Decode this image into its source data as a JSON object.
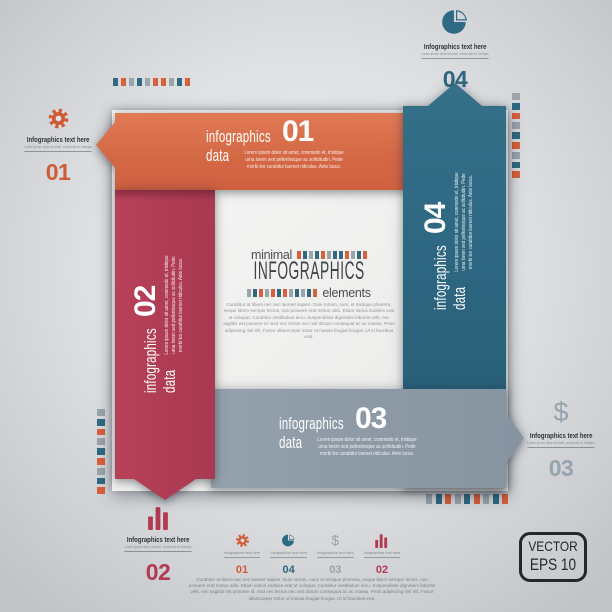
{
  "palette": {
    "orange": "#d2643f",
    "red": "#b23d54",
    "blue": "#2e6781",
    "gray_ribbon": "#8e9ba6",
    "badge_dark": "#24282d",
    "sheet": "#f2f2f1"
  },
  "strip_palette": {
    "t": "#2f6a82",
    "o": "#d9603c",
    "g": "#9aa5ac"
  },
  "strips": {
    "top": [
      "t",
      "o",
      "g",
      "t",
      "g",
      "o",
      "o",
      "g",
      "t",
      "o"
    ],
    "right": [
      "g",
      "t",
      "o",
      "g",
      "t",
      "o",
      "g",
      "t",
      "o"
    ],
    "left": [
      "g",
      "t",
      "o",
      "g",
      "t",
      "o",
      "g",
      "t",
      "o"
    ],
    "bottom": [
      "g",
      "t",
      "o",
      "g",
      "t",
      "o",
      "g",
      "t",
      "o"
    ],
    "center_top": [
      "o",
      "t",
      "g",
      "t",
      "o",
      "g",
      "t",
      "t",
      "o",
      "g",
      "t",
      "o"
    ],
    "center_bottom": [
      "g",
      "t",
      "o",
      "g",
      "o",
      "t",
      "o",
      "g",
      "t",
      "g",
      "t",
      "o"
    ]
  },
  "ribbons": {
    "orange": {
      "label": "infographics\ndata",
      "number": "01",
      "lorem": "Lorem ipsum dolor sit amet, commodo et, tristique\nurna lorem sed pellentesque ac sollicitudin. Pede\nmorbi leo curabitur laoreet ridiculus. Ante lacus."
    },
    "red": {
      "label": "infographics\ndata",
      "number": "02",
      "lorem": "Lorem ipsum dolor sit amet, commodo et, tristique\nurna lorem sed pellentesque ac sollicitudin. Pede\nmorbi leo curabitur laoreet ridiculus. Ante lacus."
    },
    "gray": {
      "label": "infographics\ndata",
      "number": "03",
      "lorem": "Lorem ipsum dolor sit amet, commodo et, tristique\nurna lorem sed pellentesque ac sollicitudin. Pede\nmorbi leo curabitur laoreet ridiculus. Ante lacus."
    },
    "blue": {
      "label": "infographics\ndata",
      "number": "04",
      "lorem": "Lorem ipsum dolor sit amet, commodo et, tristique\nurna lorem sed pellentesque ac sollicitudin. Pede\nmorbi leo curabitur laoreet ridiculus. Ante lacus."
    }
  },
  "center": {
    "kicker": "minimal",
    "title": "INFOGRAPHICS",
    "tail": "elements",
    "paragraph": "Curabitur at libero nec nec laoreet sapien. Duis rutrum, nunc et tristique pharetra, neque libero semper lectus, non posuere erat metus odio. Etiam varius sodales erat ut volutpat. Curabitur vestibulum arcu. Suspendisse dignissim lobortis velit, nec sagittis est posuere id. Sed nec lectus nec nisl dictum consequat ac ac massa. Proin adipiscing nisl elit. Fusce ullamcorper tortor ut massa feugiat feugiat. Ut id faucibus erat."
  },
  "callouts": [
    {
      "icon": "gear",
      "label": "Infographics text here",
      "sub": "Lorem ipsum dolor sit amet, commodo et, tristique",
      "number": "01"
    },
    {
      "icon": "pie",
      "label": "Infographics text here",
      "sub": "Lorem ipsum dolor sit amet, commodo et, tristique",
      "number": "04"
    },
    {
      "icon": "dollar",
      "label": "Infographics text here",
      "sub": "Lorem ipsum dolor sit amet, commodo et, tristique",
      "number": "03"
    },
    {
      "icon": "bars",
      "label": "Infographics text here",
      "sub": "Lorem ipsum dolor sit amet, commodo et, tristique",
      "number": "02"
    }
  ],
  "legend": {
    "items": [
      {
        "icon": "gear",
        "label": "Infographics text here",
        "number": "01"
      },
      {
        "icon": "pie",
        "label": "Infographics text here",
        "number": "04"
      },
      {
        "icon": "dollar",
        "label": "Infographics text here",
        "number": "03"
      },
      {
        "icon": "bars",
        "label": "Infographics text here",
        "number": "02"
      }
    ],
    "paragraph": "Curabitur at libero nec nec laoreet sapien. Duis rutrum, nunc et tristique pharetra, neque libero semper lectus, non posuere erat metus odio. Etiam varius sodales erat ut volutpat. Curabitur vestibulum arcu. Suspendisse dignissim lobortis velit, nec sagittis est posuere id. Sed nec lectus nec nisl dictum consequat ac ac massa. Proin adipiscing nisl elit. Fusce ullamcorper tortor ut massa feugiat feugiat. Ut id faucibus erat."
  },
  "badge": {
    "line1": "VECTOR",
    "line2": "EPS 10"
  },
  "icons": {
    "dollar_glyph": "$"
  }
}
